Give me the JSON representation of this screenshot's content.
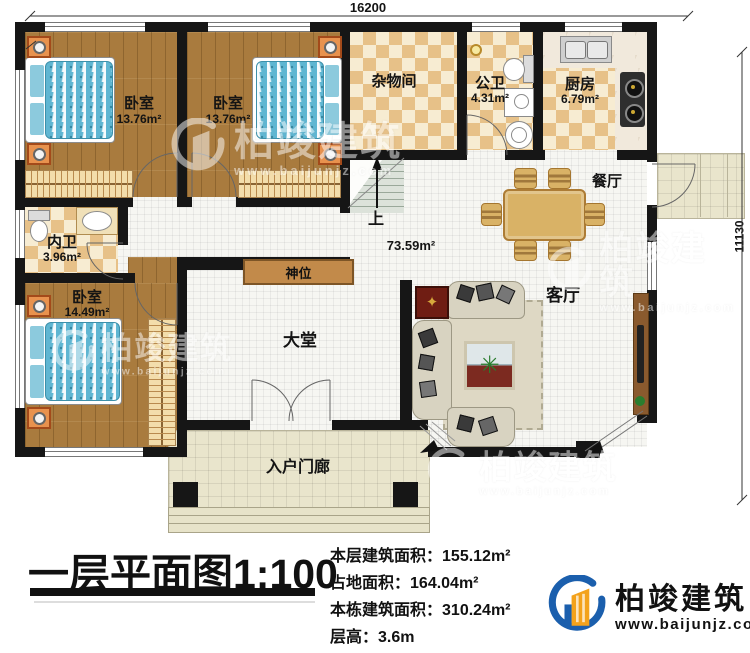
{
  "dimensions": {
    "top": "16200",
    "right": "11130"
  },
  "rooms": {
    "bedroom_tl": {
      "name": "卧室",
      "area": "13.76m²"
    },
    "bedroom_tm": {
      "name": "卧室",
      "area": "13.76m²"
    },
    "storage": {
      "name": "杂物间"
    },
    "public_bath": {
      "name": "公卫",
      "area": "4.31m²"
    },
    "kitchen": {
      "name": "厨房",
      "area": "6.79m²"
    },
    "dining": {
      "name": "餐厅"
    },
    "inner_bath": {
      "name": "内卫",
      "area": "3.96m²"
    },
    "bedroom_bl": {
      "name": "卧室",
      "area": "14.49m²"
    },
    "hall": {
      "name": "大堂",
      "area": "73.59m²"
    },
    "living": {
      "name": "客厅"
    },
    "shrine": {
      "name": "神位"
    },
    "entry_porch": {
      "name": "入户门廊"
    },
    "stairs": {
      "up": "上"
    }
  },
  "title_block": {
    "title": "一层平面图",
    "scale": "1:100",
    "stats": [
      {
        "label": "本层建筑面积：",
        "value": "155.12m²"
      },
      {
        "label": "占地面积：",
        "value": "164.04m²"
      },
      {
        "label": "本栋建筑面积：",
        "value": "310.24m²"
      },
      {
        "label": "层高：",
        "value": "3.6m"
      }
    ]
  },
  "brand": {
    "name": "柏竣建筑",
    "url": "www.baijunjz.com"
  }
}
